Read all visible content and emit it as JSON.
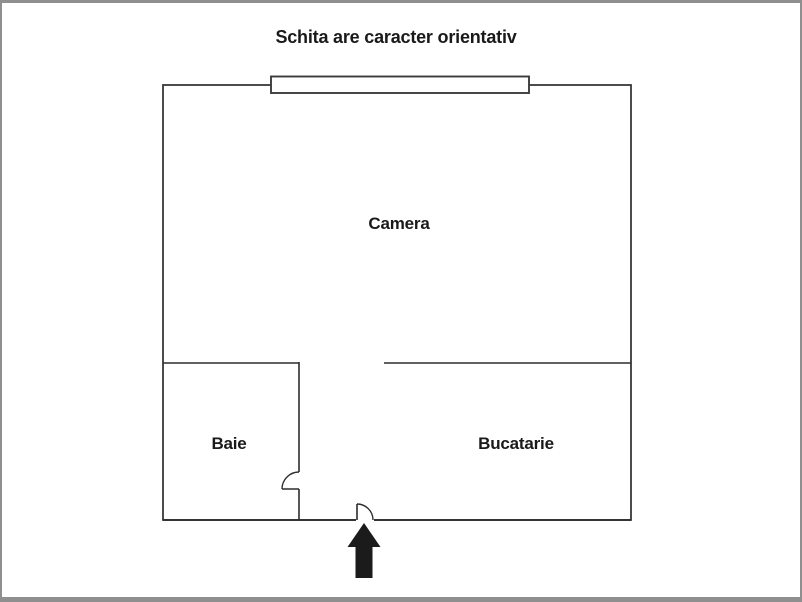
{
  "page": {
    "title": "Schita are caracter orientativ",
    "background_color": "#ffffff",
    "border_color": "#8f8f8f"
  },
  "floor_plan": {
    "rooms": [
      {
        "label": "Camera"
      },
      {
        "label": "Baie"
      },
      {
        "label": "Bucatarie"
      }
    ],
    "features": {
      "window": "window-on-top-wall",
      "baie_door": "quarter-arc-door-in-baie-wall",
      "entrance_door": "quarter-arc-door-in-bottom-wall",
      "entrance_arrow": "black-up-arrow-below-entrance"
    },
    "colors": {
      "wall": "#2d2d2d",
      "window_stroke": "#3c3c3c",
      "arrow": "#1b1b1b",
      "text": "#1a1a1a"
    }
  }
}
